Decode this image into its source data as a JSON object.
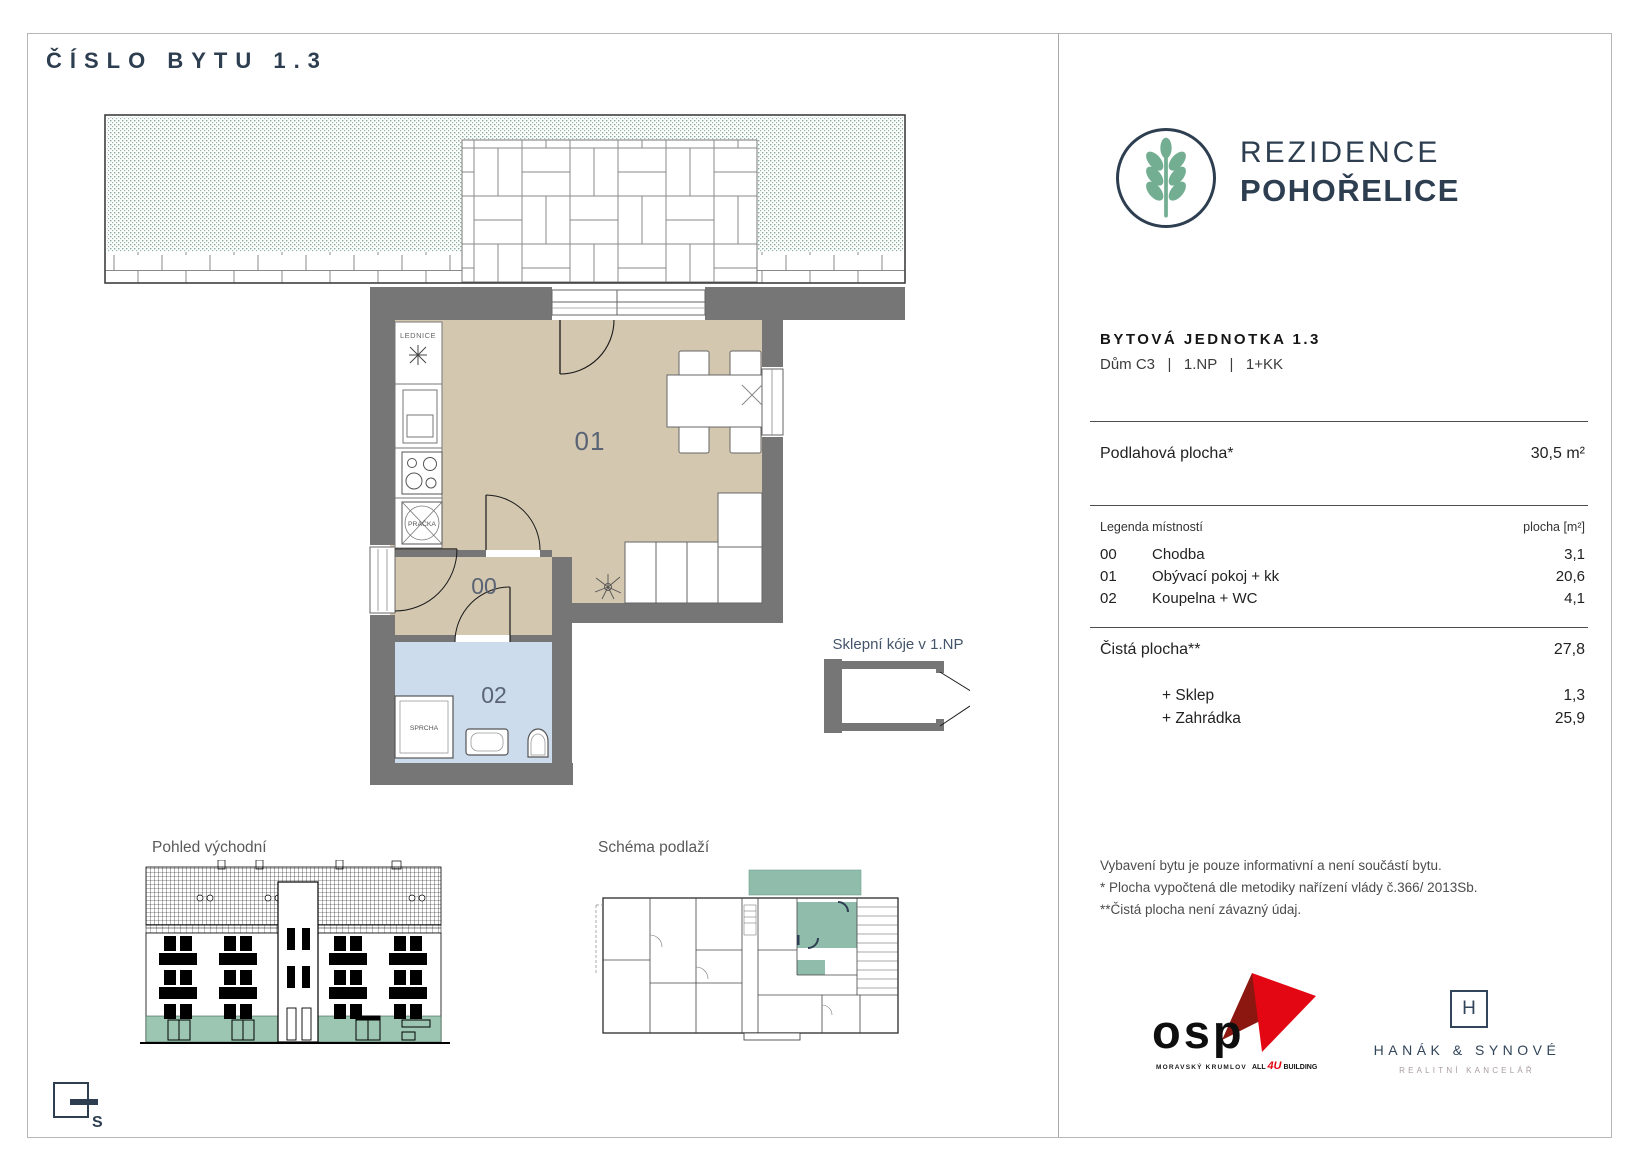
{
  "page": {
    "title": "ČÍSLO BYTU 1.3"
  },
  "brand": {
    "name_line1": "REZIDENCE",
    "name_line2": "POHOŘELICE"
  },
  "unit": {
    "heading": "BYTOVÁ JEDNOTKA 1.3",
    "subheading": "Dům C3   |   1.NP   |   1+KK",
    "floor_area_label": "Podlahová plocha*",
    "floor_area_value": "30,5 m²",
    "legend_title": "Legenda místností",
    "legend_area_header": "plocha [m²]",
    "rooms": [
      {
        "code": "00",
        "name": "Chodba",
        "area": "3,1"
      },
      {
        "code": "01",
        "name": "Obývací pokoj + kk",
        "area": "20,6"
      },
      {
        "code": "02",
        "name": "Koupelna + WC",
        "area": "4,1"
      }
    ],
    "net_area_label": "Čistá plocha**",
    "net_area_value": "27,8",
    "extras": [
      {
        "label": "+ Sklep",
        "value": "1,3"
      },
      {
        "label": "+ Zahrádka",
        "value": "25,9"
      }
    ],
    "notes": [
      "Vybavení bytu je pouze informativní a není součástí bytu.",
      "* Plocha vypočtená dle metodiky nařízení vlády č.366/ 2013Sb.",
      "**Čistá plocha není závazný údaj."
    ]
  },
  "floorplan": {
    "fixtures": {
      "fridge": "LEDNICE",
      "washer": "PRAČKA",
      "shower": "SPRCHA"
    },
    "cellar_caption": "Sklepní kóje v 1.NP"
  },
  "captions": {
    "elevation": "Pohled východní",
    "schema": "Schéma podlaží"
  },
  "compass": {
    "north_label": "S"
  },
  "logos": {
    "osp": {
      "name": "osp",
      "city": "MORAVSKÝ KRUMLOV",
      "tag_all": "ALL",
      "tag_4u": "4U",
      "tag_building": "BUILDING"
    },
    "hanak": {
      "monogram": "H",
      "name": "HANÁK & SYNOVÉ",
      "subtitle": "REALITNÍ KANCELÁŘ"
    }
  },
  "colors": {
    "accent_navy": "#2d3e50",
    "logo_green": "#74ae92",
    "floor_beige": "#d3c7b0",
    "floor_blue": "#ccdcec",
    "wall_gray": "#767677",
    "band_green": "#9cc6b2",
    "highlight_green": "#8fbcab",
    "osp_red": "#e30613",
    "osp_dark_red": "#8c1710"
  }
}
